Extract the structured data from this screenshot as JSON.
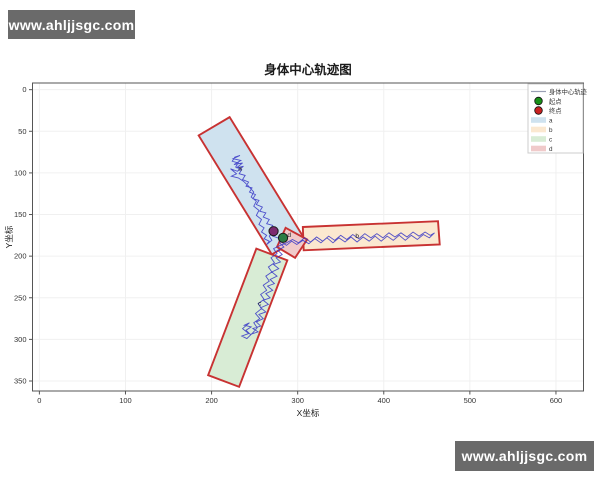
{
  "watermark": {
    "text": "www.ahljjsgc.com"
  },
  "chart_data": {
    "type": "line",
    "title": "身体中心轨迹图",
    "xlabel": "X坐标",
    "ylabel": "Y坐标",
    "xlim": [
      -8,
      632
    ],
    "ylim": [
      362,
      -8
    ],
    "y_axis_inverted": true,
    "xticks": [
      0,
      100,
      200,
      300,
      400,
      500,
      600
    ],
    "yticks": [
      0,
      50,
      100,
      150,
      200,
      250,
      300,
      350
    ],
    "grid": true,
    "grid_color": "#f0f0f0",
    "frame_color": "#555555",
    "region_edge_color": "#c83232",
    "regions": [
      {
        "name": "a",
        "fill": "#cfe2ef",
        "points": [
          [
            221,
            33
          ],
          [
            185,
            55
          ],
          [
            270,
            198
          ],
          [
            306,
            176
          ]
        ],
        "label_pos": [
          231,
          97
        ]
      },
      {
        "name": "b",
        "fill": "#fbe8d0",
        "points": [
          [
            306,
            165
          ],
          [
            463,
            158
          ],
          [
            465,
            186
          ],
          [
            307,
            193
          ]
        ],
        "label_pos": [
          367,
          178
        ]
      },
      {
        "name": "c",
        "fill": "#d8ecd5",
        "points": [
          [
            252,
            191
          ],
          [
            288,
            205
          ],
          [
            232,
            357
          ],
          [
            196,
            343
          ]
        ],
        "label_pos": [
          254,
          259
        ]
      },
      {
        "name": "d",
        "fill": "#f0caca",
        "points": [
          [
            286,
            166
          ],
          [
            311,
            180
          ],
          [
            297,
            202
          ],
          [
            276,
            189
          ]
        ],
        "label_pos": [
          288,
          177
        ]
      }
    ],
    "trajectory": {
      "name": "身体中心轨迹",
      "color": "#3535c5",
      "points": [
        [
          283,
          178
        ],
        [
          279,
          184
        ],
        [
          284,
          189
        ],
        [
          277,
          193
        ],
        [
          282,
          198
        ],
        [
          275,
          202
        ],
        [
          280,
          207
        ],
        [
          272,
          210
        ],
        [
          278,
          215
        ],
        [
          270,
          219
        ],
        [
          276,
          224
        ],
        [
          268,
          228
        ],
        [
          273,
          233
        ],
        [
          265,
          236
        ],
        [
          271,
          241
        ],
        [
          263,
          245
        ],
        [
          268,
          250
        ],
        [
          260,
          253
        ],
        [
          266,
          258
        ],
        [
          257,
          262
        ],
        [
          263,
          267
        ],
        [
          255,
          270
        ],
        [
          260,
          275
        ],
        [
          252,
          279
        ],
        [
          257,
          284
        ],
        [
          248,
          287
        ],
        [
          254,
          291
        ],
        [
          245,
          294
        ],
        [
          240,
          289
        ],
        [
          246,
          285
        ],
        [
          238,
          283
        ],
        [
          244,
          280
        ],
        [
          236,
          287
        ],
        [
          243,
          293
        ],
        [
          235,
          296
        ],
        [
          241,
          299
        ],
        [
          248,
          292
        ],
        [
          253,
          286
        ],
        [
          249,
          280
        ],
        [
          256,
          275
        ],
        [
          251,
          269
        ],
        [
          258,
          263
        ],
        [
          254,
          257
        ],
        [
          261,
          252
        ],
        [
          257,
          246
        ],
        [
          264,
          241
        ],
        [
          260,
          235
        ],
        [
          267,
          230
        ],
        [
          263,
          224
        ],
        [
          270,
          219
        ],
        [
          266,
          213
        ],
        [
          273,
          208
        ],
        [
          269,
          202
        ],
        [
          276,
          197
        ],
        [
          272,
          191
        ],
        [
          280,
          187
        ],
        [
          287,
          184
        ],
        [
          294,
          180
        ],
        [
          301,
          184
        ],
        [
          308,
          178
        ],
        [
          315,
          183
        ],
        [
          322,
          177
        ],
        [
          329,
          182
        ],
        [
          336,
          176
        ],
        [
          343,
          181
        ],
        [
          350,
          175
        ],
        [
          357,
          180
        ],
        [
          364,
          174
        ],
        [
          371,
          179
        ],
        [
          378,
          173
        ],
        [
          385,
          178
        ],
        [
          392,
          173
        ],
        [
          399,
          178
        ],
        [
          406,
          172
        ],
        [
          413,
          177
        ],
        [
          420,
          172
        ],
        [
          427,
          177
        ],
        [
          434,
          171
        ],
        [
          441,
          176
        ],
        [
          448,
          171
        ],
        [
          454,
          175
        ],
        [
          459,
          172
        ],
        [
          453,
          178
        ],
        [
          446,
          174
        ],
        [
          439,
          180
        ],
        [
          432,
          175
        ],
        [
          425,
          181
        ],
        [
          418,
          175
        ],
        [
          411,
          181
        ],
        [
          404,
          176
        ],
        [
          397,
          182
        ],
        [
          390,
          176
        ],
        [
          383,
          182
        ],
        [
          376,
          177
        ],
        [
          369,
          183
        ],
        [
          362,
          177
        ],
        [
          355,
          183
        ],
        [
          348,
          178
        ],
        [
          341,
          184
        ],
        [
          334,
          178
        ],
        [
          327,
          184
        ],
        [
          320,
          179
        ],
        [
          313,
          185
        ],
        [
          306,
          181
        ],
        [
          299,
          186
        ],
        [
          293,
          182
        ],
        [
          287,
          187
        ],
        [
          281,
          183
        ],
        [
          277,
          178
        ],
        [
          271,
          176
        ],
        [
          274,
          171
        ],
        [
          268,
          168
        ],
        [
          271,
          163
        ],
        [
          264,
          161
        ],
        [
          267,
          156
        ],
        [
          260,
          153
        ],
        [
          263,
          148
        ],
        [
          256,
          146
        ],
        [
          259,
          141
        ],
        [
          252,
          138
        ],
        [
          255,
          133
        ],
        [
          248,
          131
        ],
        [
          251,
          126
        ],
        [
          244,
          123
        ],
        [
          247,
          118
        ],
        [
          240,
          116
        ],
        [
          243,
          111
        ],
        [
          236,
          108
        ],
        [
          239,
          103
        ],
        [
          232,
          101
        ],
        [
          235,
          96
        ],
        [
          228,
          93
        ],
        [
          231,
          88
        ],
        [
          224,
          86
        ],
        [
          227,
          81
        ],
        [
          233,
          79
        ],
        [
          225,
          83
        ],
        [
          234,
          85
        ],
        [
          226,
          90
        ],
        [
          236,
          88
        ],
        [
          229,
          94
        ],
        [
          237,
          92
        ],
        [
          230,
          98
        ],
        [
          222,
          95
        ],
        [
          229,
          101
        ],
        [
          223,
          104
        ],
        [
          231,
          106
        ],
        [
          237,
          110
        ],
        [
          243,
          116
        ],
        [
          249,
          123
        ],
        [
          246,
          129
        ],
        [
          252,
          134
        ],
        [
          249,
          140
        ],
        [
          255,
          145
        ],
        [
          252,
          151
        ],
        [
          258,
          156
        ],
        [
          255,
          162
        ],
        [
          261,
          166
        ],
        [
          258,
          171
        ],
        [
          264,
          175
        ],
        [
          261,
          179
        ],
        [
          267,
          182
        ],
        [
          264,
          186
        ],
        [
          270,
          181
        ],
        [
          267,
          176
        ],
        [
          272,
          170
        ]
      ]
    },
    "markers": [
      {
        "name": "终点",
        "pos": [
          272,
          170
        ],
        "fill": "#7c2a70",
        "edge": "#1a1a1a"
      },
      {
        "name": "起点",
        "pos": [
          283,
          178
        ],
        "fill": "#2a7d44",
        "edge": "#1a1a1a"
      }
    ],
    "legend": {
      "position": "upper right",
      "entries": [
        {
          "type": "line",
          "label": "身体中心轨迹",
          "color": "#9aa0b5"
        },
        {
          "type": "marker",
          "label": "起点",
          "color": "#189018"
        },
        {
          "type": "marker",
          "label": "终点",
          "color": "#c92121"
        },
        {
          "type": "patch",
          "label": "a",
          "color": "#cfe2ef"
        },
        {
          "type": "patch",
          "label": "b",
          "color": "#fbe8d0"
        },
        {
          "type": "patch",
          "label": "c",
          "color": "#d8ecd5"
        },
        {
          "type": "patch",
          "label": "d",
          "color": "#f0caca"
        }
      ]
    }
  }
}
